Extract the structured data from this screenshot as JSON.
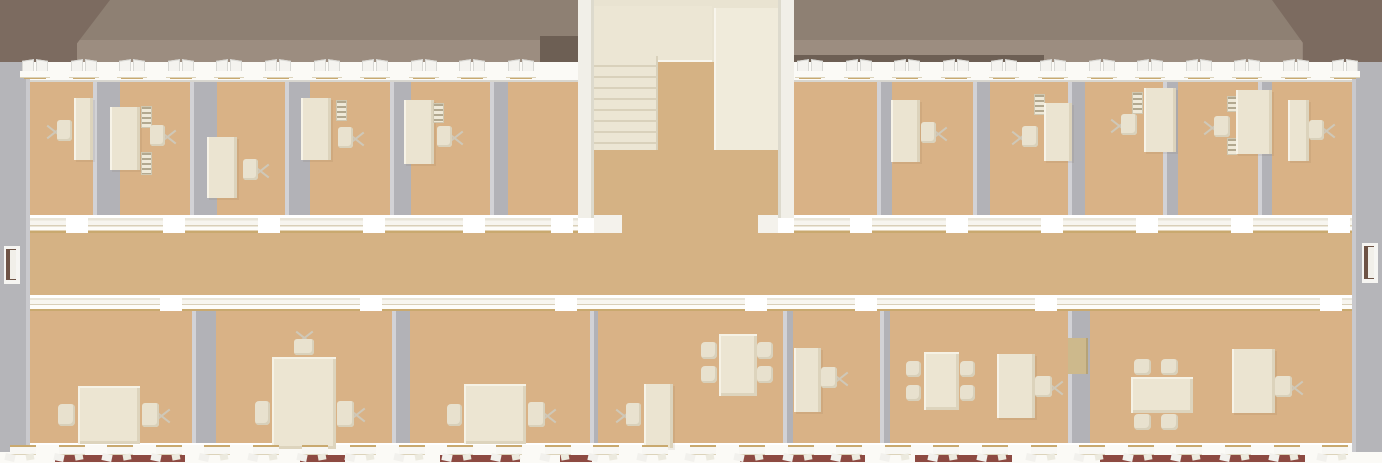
{
  "meta": {
    "description": "Top-down 3D architectural render of one floor of an office building: two rows of offices with desks, chairs, shelves and meeting tables, a central corridor, a central stairwell, hipped roof at both ends, and window bands on both facades. No text or UI chrome is visible.",
    "canvas": {
      "w": 1382,
      "h": 463
    }
  },
  "palette": {
    "roof_upper": "#8e8073",
    "roof_lower": "#9c8d80",
    "roof_hip_dark": "#7c6b60",
    "eave_shadow": "#6d5f54",
    "ridge_accent": "#a03c34",
    "wall_white": "#fbfaf6",
    "wall_shadow": "#d8d6cf",
    "side_gray": "#b5b5b9",
    "side_gray_light": "#c9c9cd",
    "floor_tan": "#d9b286",
    "corridor_tan": "#d5b284",
    "partition_gray": "#b2b2b7",
    "partition_edge": "#d2d2d6",
    "cream": "#ebe4d1",
    "cream_light": "#f2eee0",
    "cream_dark": "#dcd3bc",
    "stair_hall": "#e9e3d1",
    "stair_block": "#f0ebdb",
    "gold_trim": "#c9a96f",
    "brick_red": "#8d4a42",
    "door_dark": "#6e5345",
    "door_khaki": "#cdb98c"
  },
  "roof": {
    "ridge_y": 40,
    "bottom_y": 62,
    "left_hip": {
      "x": 0,
      "y": 0,
      "w": 110,
      "h": 62
    },
    "right_hip": {
      "x": 1272,
      "y": 0,
      "w": 110,
      "h": 70
    },
    "eave_shadows": [
      {
        "x": 540,
        "y": 36,
        "w": 38,
        "h": 26
      },
      {
        "x": 794,
        "y": 55,
        "w": 250,
        "h": 8
      }
    ],
    "ridge_accents": [
      {
        "x": 1193,
        "y": 66,
        "w": 77,
        "h": 4
      }
    ]
  },
  "exterior": {
    "top_band": {
      "x": 0,
      "y": 62,
      "w": 1382,
      "h": 20
    },
    "bottom_band": {
      "x": 0,
      "y": 443,
      "w": 1382,
      "h": 20
    },
    "left_wall": {
      "x": 0,
      "y": 62,
      "w": 30,
      "h": 390
    },
    "right_wall": {
      "x": 1352,
      "y": 62,
      "w": 30,
      "h": 390
    },
    "brick_strips": [
      [
        55,
        185
      ],
      [
        300,
        345
      ],
      [
        440,
        520
      ],
      [
        560,
        592
      ],
      [
        740,
        865
      ],
      [
        915,
        1012
      ],
      [
        1100,
        1305
      ]
    ],
    "end_doors": [
      {
        "side": "left",
        "x": 4,
        "y": 246,
        "w": 16,
        "h": 38
      },
      {
        "side": "right",
        "x": 1362,
        "y": 243,
        "w": 16,
        "h": 40
      }
    ]
  },
  "windows": {
    "top": {
      "y": 58,
      "pitch": 48.6,
      "ranges": [
        [
          22,
          578
        ],
        [
          797,
          1368
        ]
      ]
    },
    "bottom": {
      "y": 445,
      "pitch": 48.6,
      "ranges": [
        [
          10,
          1370
        ]
      ]
    }
  },
  "floors": {
    "top_rooms": [
      {
        "x": 30,
        "y": 82,
        "w": 548,
        "h": 133
      },
      {
        "x": 794,
        "y": 82,
        "w": 558,
        "h": 133
      }
    ],
    "corridor": {
      "x": 30,
      "y": 233,
      "w": 1322,
      "h": 62
    },
    "corridor_opening": {
      "x": 622,
      "y": 215,
      "w": 136,
      "h": 18
    },
    "bottom_rooms": {
      "x": 30,
      "y": 311,
      "w": 1322,
      "h": 132
    }
  },
  "corridor_walls": {
    "upper": {
      "y": 215,
      "h": 18,
      "spans": [
        {
          "range": [
            30,
            578
          ],
          "gaps": [
            [
              66,
              88
            ],
            [
              163,
              185
            ],
            [
              258,
              280
            ],
            [
              363,
              385
            ],
            [
              463,
              485
            ],
            [
              551,
              573
            ]
          ]
        },
        {
          "range": [
            794,
            1352
          ],
          "gaps": [
            [
              850,
              872
            ],
            [
              946,
              968
            ],
            [
              1041,
              1063
            ],
            [
              1136,
              1158
            ],
            [
              1231,
              1253
            ],
            [
              1328,
              1350
            ]
          ]
        }
      ]
    },
    "lower": {
      "y": 295,
      "h": 16,
      "spans": [
        {
          "range": [
            30,
            1352
          ],
          "gaps": [
            [
              160,
              182
            ],
            [
              360,
              382
            ],
            [
              555,
              577
            ],
            [
              745,
              767
            ],
            [
              855,
              877
            ],
            [
              1035,
              1057
            ],
            [
              1320,
              1342
            ]
          ]
        }
      ]
    },
    "stubs": [
      {
        "x": 594,
        "y": 215,
        "w": 28,
        "h": 18
      },
      {
        "x": 758,
        "y": 215,
        "w": 20,
        "h": 18
      }
    ]
  },
  "partitions": {
    "top": {
      "y": 82,
      "h": 133,
      "walls": [
        {
          "x": 93,
          "w": 27
        },
        {
          "x": 190,
          "w": 27
        },
        {
          "x": 285,
          "w": 25
        },
        {
          "x": 390,
          "w": 21
        },
        {
          "x": 490,
          "w": 18
        },
        {
          "x": 877,
          "w": 15
        },
        {
          "x": 973,
          "w": 17
        },
        {
          "x": 1068,
          "w": 17
        },
        {
          "x": 1163,
          "w": 15
        },
        {
          "x": 1258,
          "w": 14
        }
      ]
    },
    "bottom": {
      "y": 311,
      "h": 132,
      "walls": [
        {
          "x": 192,
          "w": 24
        },
        {
          "x": 392,
          "w": 18
        },
        {
          "x": 590,
          "w": 8
        },
        {
          "x": 783,
          "w": 10
        },
        {
          "x": 880,
          "w": 10
        },
        {
          "x": 1068,
          "w": 22
        }
      ]
    }
  },
  "stairwell": {
    "left_side_wall": {
      "x": 578,
      "y": 0,
      "w": 16,
      "h": 218
    },
    "right_side_wall": {
      "x": 778,
      "y": 0,
      "w": 16,
      "h": 218
    },
    "hall": {
      "x": 594,
      "y": 0,
      "w": 184,
      "h": 215
    },
    "landing": {
      "x": 594,
      "y": 6,
      "w": 118,
      "h": 56
    },
    "stairs": {
      "x": 594,
      "y": 56,
      "w": 64,
      "h": 96
    },
    "upper_flight_wall": {
      "x": 714,
      "y": 8,
      "w": 64,
      "h": 142
    },
    "mid_floor": {
      "x": 658,
      "y": 62,
      "w": 56,
      "h": 90
    },
    "lower_floor": {
      "x": 594,
      "y": 150,
      "w": 184,
      "h": 65
    }
  },
  "furniture": {
    "top_row": [
      {
        "type": "desk",
        "x": 74,
        "y": 98,
        "w": 19,
        "h": 62
      },
      {
        "type": "office-chair",
        "x": 57,
        "y": 120,
        "w": 15,
        "h": 21,
        "legs": "left"
      },
      {
        "type": "desk",
        "x": 110,
        "y": 107,
        "w": 30,
        "h": 63
      },
      {
        "type": "shelf",
        "x": 141,
        "y": 106,
        "w": 11,
        "h": 22
      },
      {
        "type": "shelf",
        "x": 141,
        "y": 152,
        "w": 11,
        "h": 23
      },
      {
        "type": "office-chair",
        "x": 150,
        "y": 125,
        "w": 15,
        "h": 21,
        "legs": "right"
      },
      {
        "type": "desk",
        "x": 207,
        "y": 137,
        "w": 30,
        "h": 61
      },
      {
        "type": "office-chair",
        "x": 243,
        "y": 159,
        "w": 15,
        "h": 21,
        "legs": "right"
      },
      {
        "type": "desk",
        "x": 301,
        "y": 98,
        "w": 30,
        "h": 62
      },
      {
        "type": "shelf",
        "x": 336,
        "y": 100,
        "w": 11,
        "h": 21
      },
      {
        "type": "office-chair",
        "x": 338,
        "y": 127,
        "w": 15,
        "h": 21,
        "legs": "right"
      },
      {
        "type": "desk",
        "x": 404,
        "y": 100,
        "w": 30,
        "h": 64
      },
      {
        "type": "shelf",
        "x": 433,
        "y": 103,
        "w": 11,
        "h": 20
      },
      {
        "type": "office-chair",
        "x": 437,
        "y": 126,
        "w": 15,
        "h": 21,
        "legs": "right"
      },
      {
        "type": "desk",
        "x": 891,
        "y": 100,
        "w": 29,
        "h": 62
      },
      {
        "type": "office-chair",
        "x": 921,
        "y": 122,
        "w": 15,
        "h": 21,
        "legs": "right"
      },
      {
        "type": "shelf",
        "x": 1034,
        "y": 94,
        "w": 11,
        "h": 21
      },
      {
        "type": "office-chair",
        "x": 1022,
        "y": 126,
        "w": 16,
        "h": 21,
        "legs": "left"
      },
      {
        "type": "desk",
        "x": 1044,
        "y": 103,
        "w": 28,
        "h": 58
      },
      {
        "type": "shelf",
        "x": 1132,
        "y": 92,
        "w": 11,
        "h": 22
      },
      {
        "type": "office-chair",
        "x": 1121,
        "y": 114,
        "w": 16,
        "h": 21,
        "legs": "left"
      },
      {
        "type": "desk",
        "x": 1144,
        "y": 88,
        "w": 32,
        "h": 64
      },
      {
        "type": "shelf",
        "x": 1227,
        "y": 96,
        "w": 10,
        "h": 16
      },
      {
        "type": "shelf",
        "x": 1227,
        "y": 138,
        "w": 10,
        "h": 17
      },
      {
        "type": "office-chair",
        "x": 1214,
        "y": 116,
        "w": 16,
        "h": 21,
        "legs": "left"
      },
      {
        "type": "desk",
        "x": 1236,
        "y": 90,
        "w": 36,
        "h": 64
      },
      {
        "type": "desk",
        "x": 1288,
        "y": 100,
        "w": 21,
        "h": 61
      },
      {
        "type": "office-chair",
        "x": 1309,
        "y": 120,
        "w": 15,
        "h": 20,
        "legs": "right"
      }
    ],
    "bottom_row": [
      {
        "type": "meeting-table",
        "x": 78,
        "y": 386,
        "w": 62,
        "h": 58
      },
      {
        "type": "side-chair",
        "x": 58,
        "y": 404,
        "w": 17,
        "h": 22
      },
      {
        "type": "office-chair",
        "x": 142,
        "y": 403,
        "w": 17,
        "h": 24,
        "legs": "right"
      },
      {
        "type": "meeting-table",
        "x": 272,
        "y": 357,
        "w": 64,
        "h": 92
      },
      {
        "type": "office-chair",
        "x": 294,
        "y": 339,
        "w": 20,
        "h": 16,
        "legs": "top"
      },
      {
        "type": "side-chair",
        "x": 255,
        "y": 401,
        "w": 15,
        "h": 24
      },
      {
        "type": "office-chair",
        "x": 337,
        "y": 401,
        "w": 17,
        "h": 26,
        "legs": "right"
      },
      {
        "type": "meeting-table",
        "x": 464,
        "y": 384,
        "w": 62,
        "h": 60
      },
      {
        "type": "side-chair",
        "x": 447,
        "y": 404,
        "w": 15,
        "h": 22
      },
      {
        "type": "office-chair",
        "x": 528,
        "y": 402,
        "w": 17,
        "h": 25,
        "legs": "right"
      },
      {
        "type": "desk",
        "x": 644,
        "y": 384,
        "w": 29,
        "h": 64
      },
      {
        "type": "office-chair",
        "x": 626,
        "y": 403,
        "w": 15,
        "h": 23,
        "legs": "left"
      },
      {
        "type": "meeting-table",
        "x": 719,
        "y": 334,
        "w": 38,
        "h": 62
      },
      {
        "type": "side-chair",
        "x": 701,
        "y": 342,
        "w": 16,
        "h": 17
      },
      {
        "type": "side-chair",
        "x": 701,
        "y": 366,
        "w": 16,
        "h": 17
      },
      {
        "type": "side-chair",
        "x": 757,
        "y": 342,
        "w": 16,
        "h": 17
      },
      {
        "type": "side-chair",
        "x": 757,
        "y": 366,
        "w": 16,
        "h": 17
      },
      {
        "type": "desk",
        "x": 794,
        "y": 348,
        "w": 27,
        "h": 64
      },
      {
        "type": "office-chair",
        "x": 821,
        "y": 367,
        "w": 16,
        "h": 21,
        "legs": "right"
      },
      {
        "type": "meeting-table",
        "x": 924,
        "y": 352,
        "w": 35,
        "h": 58
      },
      {
        "type": "side-chair",
        "x": 906,
        "y": 361,
        "w": 15,
        "h": 16
      },
      {
        "type": "side-chair",
        "x": 906,
        "y": 385,
        "w": 15,
        "h": 16
      },
      {
        "type": "side-chair",
        "x": 960,
        "y": 361,
        "w": 15,
        "h": 16
      },
      {
        "type": "side-chair",
        "x": 960,
        "y": 385,
        "w": 15,
        "h": 16
      },
      {
        "type": "desk",
        "x": 997,
        "y": 354,
        "w": 38,
        "h": 64
      },
      {
        "type": "office-chair",
        "x": 1035,
        "y": 376,
        "w": 17,
        "h": 21,
        "legs": "right"
      },
      {
        "type": "door-panel",
        "x": 1068,
        "y": 338,
        "w": 20,
        "h": 36
      },
      {
        "type": "meeting-table",
        "x": 1131,
        "y": 377,
        "w": 62,
        "h": 36
      },
      {
        "type": "side-chair",
        "x": 1134,
        "y": 359,
        "w": 17,
        "h": 16
      },
      {
        "type": "side-chair",
        "x": 1161,
        "y": 359,
        "w": 17,
        "h": 16
      },
      {
        "type": "side-chair",
        "x": 1134,
        "y": 414,
        "w": 17,
        "h": 16
      },
      {
        "type": "side-chair",
        "x": 1161,
        "y": 414,
        "w": 17,
        "h": 16
      },
      {
        "type": "desk",
        "x": 1232,
        "y": 349,
        "w": 43,
        "h": 64
      },
      {
        "type": "office-chair",
        "x": 1275,
        "y": 376,
        "w": 17,
        "h": 21,
        "legs": "right"
      }
    ]
  }
}
